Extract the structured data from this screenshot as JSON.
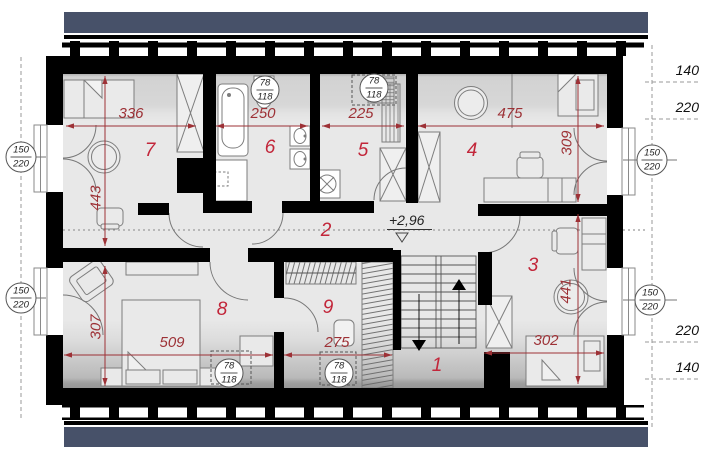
{
  "rooms": [
    {
      "n": "7",
      "x": 150,
      "y": 151
    },
    {
      "n": "6",
      "x": 270,
      "y": 148
    },
    {
      "n": "5",
      "x": 363,
      "y": 151
    },
    {
      "n": "4",
      "x": 472,
      "y": 151
    },
    {
      "n": "2",
      "x": 326,
      "y": 231
    },
    {
      "n": "8",
      "x": 222,
      "y": 310
    },
    {
      "n": "9",
      "x": 328,
      "y": 308
    },
    {
      "n": "1",
      "x": 437,
      "y": 366
    },
    {
      "n": "3",
      "x": 533,
      "y": 266
    }
  ],
  "dimensions": [
    {
      "label": "336",
      "x1": 66,
      "y1": 126,
      "x2": 196,
      "y2": 126,
      "lx": 131,
      "ly": 122,
      "rot": 0
    },
    {
      "label": "250",
      "x1": 216,
      "y1": 126,
      "x2": 308,
      "y2": 126,
      "lx": 263,
      "ly": 122,
      "rot": 0
    },
    {
      "label": "225",
      "x1": 322,
      "y1": 126,
      "x2": 404,
      "y2": 126,
      "lx": 361,
      "ly": 122,
      "rot": 0
    },
    {
      "label": "475",
      "x1": 418,
      "y1": 126,
      "x2": 604,
      "y2": 126,
      "lx": 510,
      "ly": 122,
      "rot": 0
    },
    {
      "label": "443",
      "x1": 105,
      "y1": 76,
      "x2": 105,
      "y2": 246,
      "lx": 96,
      "ly": 198,
      "rot": -90
    },
    {
      "label": "309",
      "x1": 578,
      "y1": 76,
      "x2": 578,
      "y2": 202,
      "lx": 567,
      "ly": 143,
      "rot": -90
    },
    {
      "label": "307",
      "x1": 105,
      "y1": 266,
      "x2": 105,
      "y2": 386,
      "lx": 96,
      "ly": 327,
      "rot": -90
    },
    {
      "label": "441",
      "x1": 578,
      "y1": 214,
      "x2": 578,
      "y2": 384,
      "lx": 566,
      "ly": 291,
      "rot": -90
    },
    {
      "label": "509",
      "x1": 64,
      "y1": 355,
      "x2": 273,
      "y2": 355,
      "lx": 172,
      "ly": 351,
      "rot": 0
    },
    {
      "label": "275",
      "x1": 284,
      "y1": 355,
      "x2": 392,
      "y2": 355,
      "lx": 337,
      "ly": 351,
      "rot": 0
    },
    {
      "label": "302",
      "x1": 484,
      "y1": 353,
      "x2": 604,
      "y2": 353,
      "lx": 546,
      "ly": 349,
      "rot": 0
    }
  ],
  "window_markers": [
    {
      "num": "150",
      "den": "220",
      "cx": 21,
      "cy": 157
    },
    {
      "num": "150",
      "den": "220",
      "cx": 21,
      "cy": 298
    },
    {
      "num": "150",
      "den": "220",
      "cx": 652,
      "cy": 160
    },
    {
      "num": "150",
      "den": "220",
      "cx": 650,
      "cy": 300
    }
  ],
  "roof_window_markers": [
    {
      "num": "78",
      "den": "118",
      "cx": 265,
      "cy": 90
    },
    {
      "num": "78",
      "den": "118",
      "cx": 374,
      "cy": 88
    },
    {
      "num": "78",
      "den": "118",
      "cx": 229,
      "cy": 373
    },
    {
      "num": "78",
      "den": "118",
      "cx": 339,
      "cy": 373
    }
  ],
  "side_dims": [
    {
      "label": "140",
      "x": 699,
      "y": 78
    },
    {
      "label": "220",
      "x": 699,
      "y": 115
    },
    {
      "label": "220",
      "x": 699,
      "y": 338
    },
    {
      "label": "140",
      "x": 699,
      "y": 375
    }
  ],
  "level_marker": {
    "text": "+2,96"
  },
  "colors": {
    "roof_band": "#475169",
    "wall": "#000000",
    "floor": "#e8e8e8",
    "dim_red": "#9d3136",
    "room_red": "#c2263a",
    "furniture_line": "#7d7d7d"
  }
}
